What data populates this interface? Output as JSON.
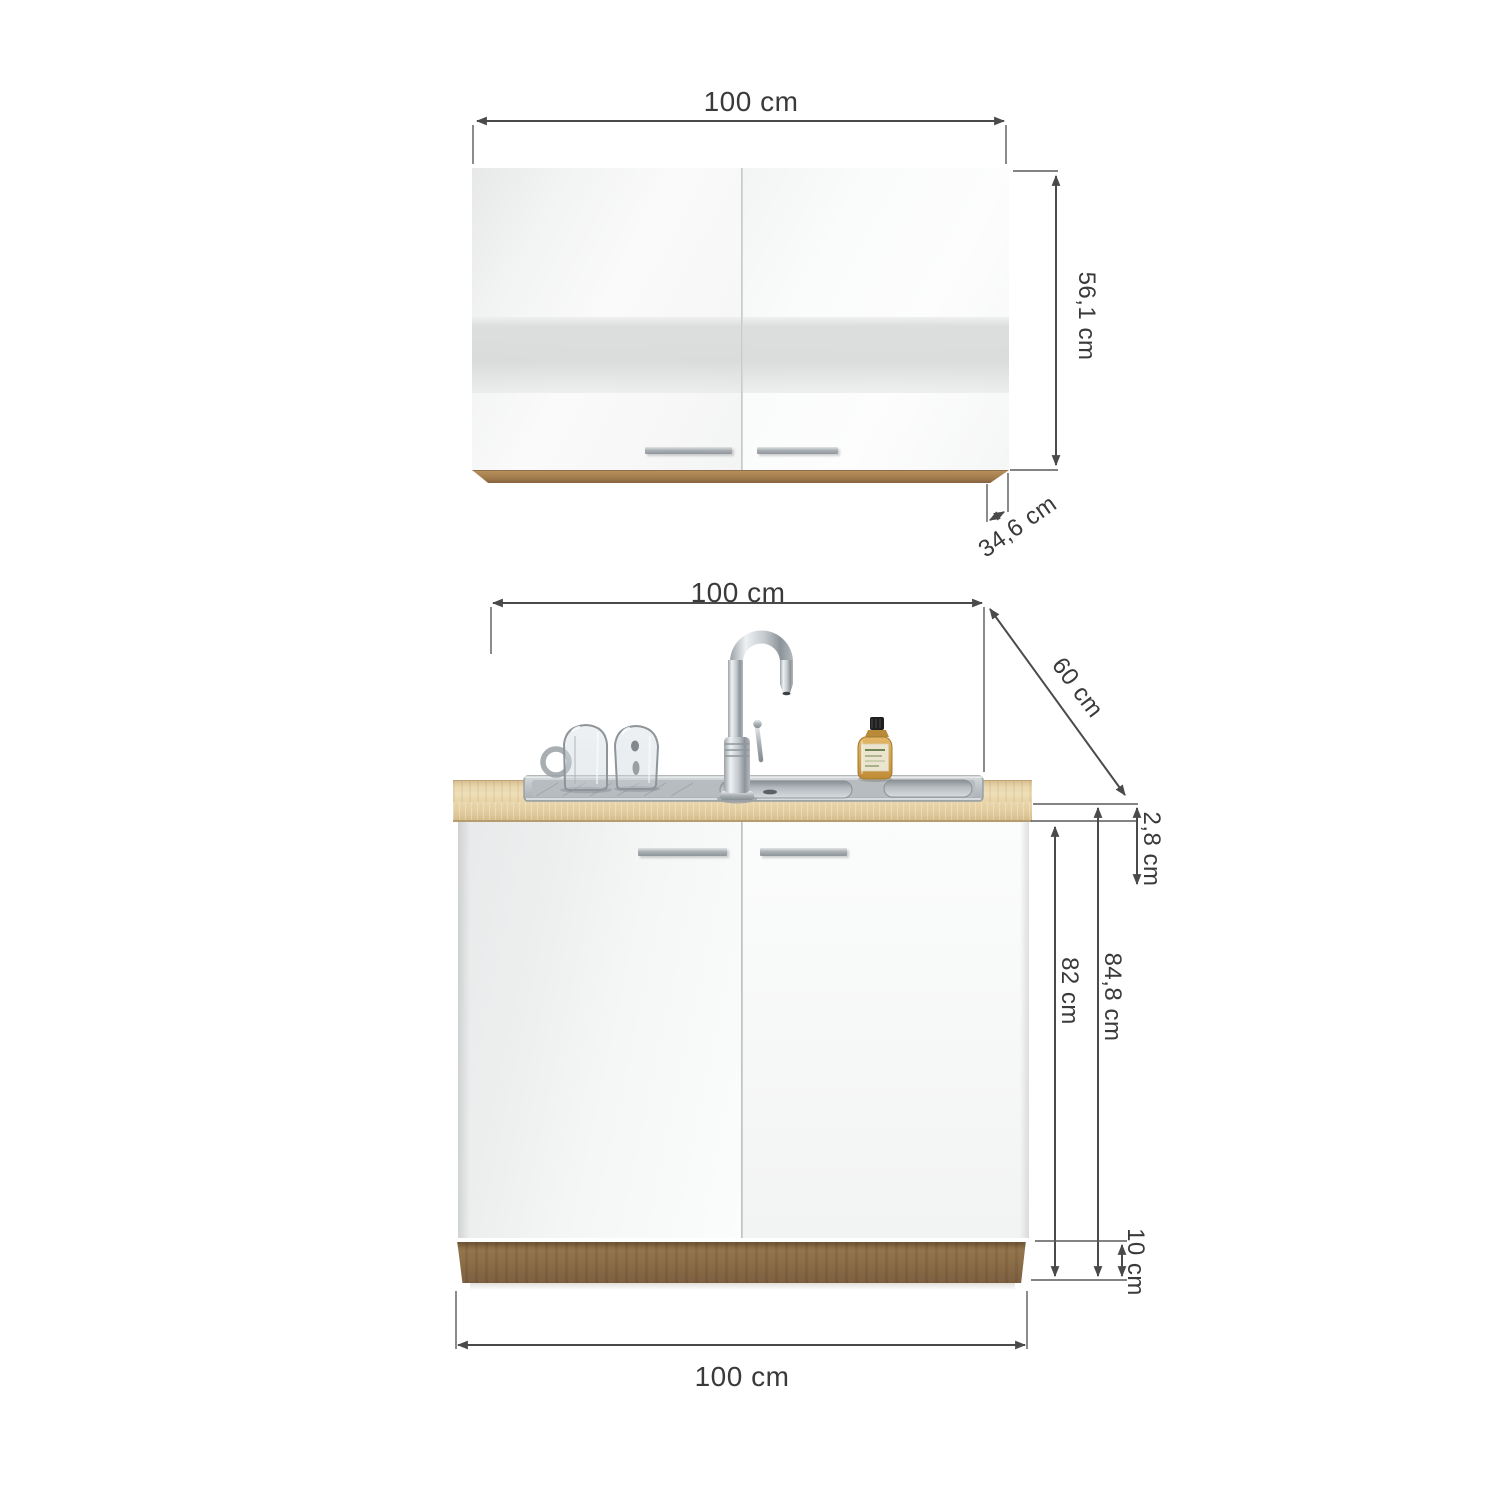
{
  "diagram": {
    "type": "kitchen-cabinet-dimension-diagram",
    "wall_cabinet": {
      "width": "100 cm",
      "height": "56,1 cm",
      "depth": "34,6 cm"
    },
    "base_cabinet": {
      "width": "100 cm",
      "depth": "60 cm",
      "countertop_thickness": "2,8 cm",
      "carcass_height": "82 cm",
      "total_height": "84,8 cm",
      "plinth_height": "10 cm",
      "bottom_width": "100 cm"
    },
    "colors": {
      "dimension_lines": "#4a4a4a",
      "label_text": "#3a3a3a",
      "door_white": "#f7f8f8",
      "oak_wood": "#a07c4f",
      "countertop_oak": "#e7d4a8",
      "stainless_steel": "#c6cbcf",
      "handle_silver": "#aab0b4",
      "bottle_amber": "#d2a04a",
      "cap_black": "#1f1f1f"
    }
  }
}
